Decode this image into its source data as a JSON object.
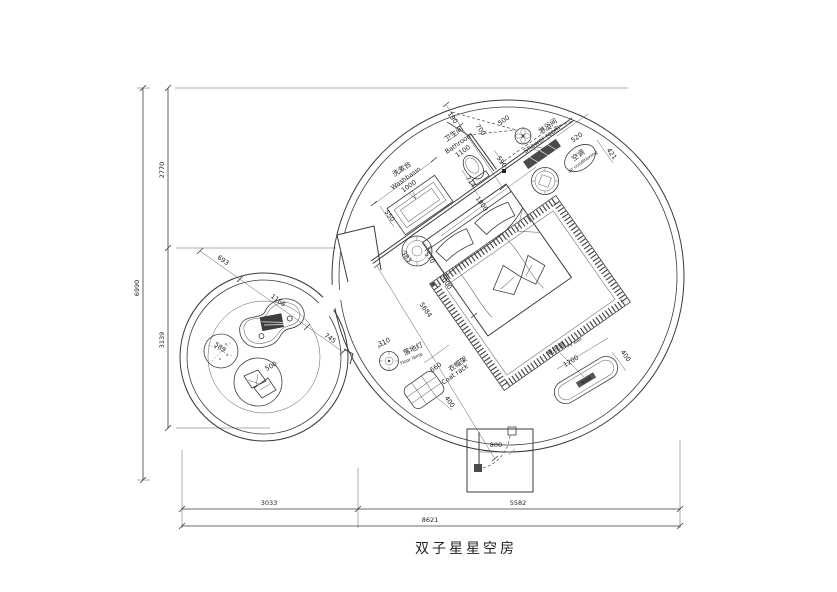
{
  "t": {
    "title": "双子星星空房",
    "dim_6990": "6990",
    "dim_2770": "2770",
    "dim_3139": "3139",
    "dim_3033": "3033",
    "dim_5582": "5582",
    "dim_8621": "8621",
    "washbasin_cn": "洗漱台",
    "washbasin_en": "Washbasin",
    "dim_1000": "1000",
    "dim_550": "550",
    "bathroom_cn": "卫生间",
    "bathroom_en": "Bathroom",
    "dim_1100": "1100",
    "dim_190": "190",
    "dim_700": "700",
    "dim_500_door": "500",
    "dim_590": "590",
    "dim_714": "714",
    "dim_1800": "1800",
    "shower_cn": "淋浴间",
    "shower_en": "Shower room",
    "ac_cn": "空调",
    "ac_en": "air conditioning",
    "dim_520": "520",
    "dim_421": "421",
    "dim_383": "383",
    "dim_570": "570",
    "dim_2000": "2000",
    "dim_5684": "5684",
    "dim_693": "693",
    "dim_1166": "1166",
    "dim_745": "745",
    "dim_589": "589",
    "dim_500_seat": "500",
    "lamp_cn": "落地灯",
    "lamp_en": "Floor lamp",
    "dim_310": "310",
    "coat_cn": "衣帽架",
    "coat_en": "Coat rack",
    "dim_660": "660",
    "dim_400_coat": "400",
    "tv_cn": "电视墙",
    "tv_en": "TV wall",
    "tv_cabinet": "电视柜",
    "dim_1200": "1200",
    "dim_400_tv": "400",
    "dim_800": "800"
  },
  "colors": {
    "line": "#3b3b3b",
    "text": "#222222",
    "dark_fill": "#4a4a4a",
    "background": "#ffffff"
  }
}
